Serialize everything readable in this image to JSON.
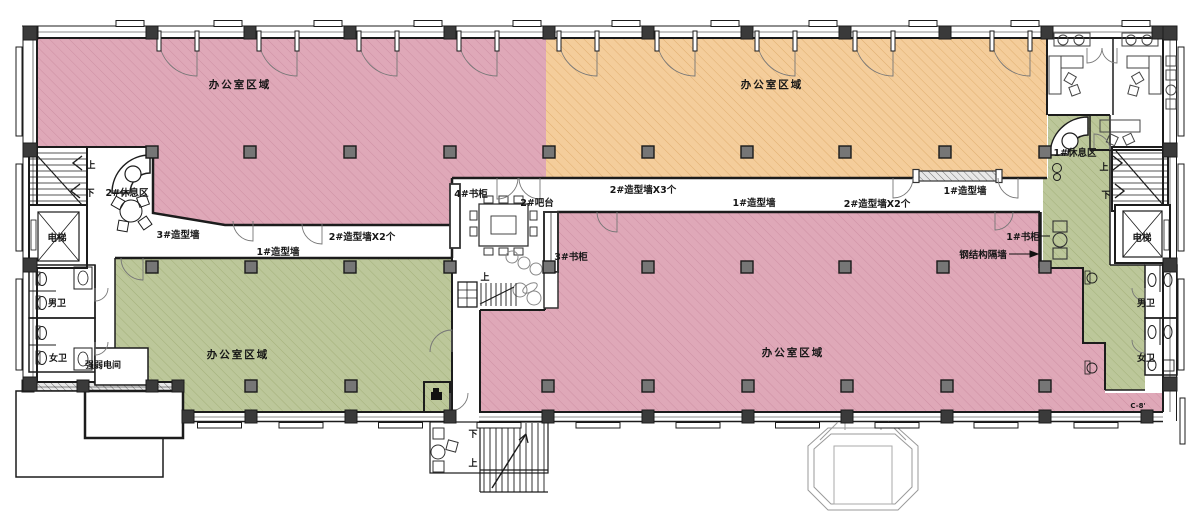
{
  "plan": {
    "type": "office-floor-plan",
    "labels": {
      "office_area_nw": "办公室区域",
      "office_area_ne": "办公室区域",
      "office_area_sw": "办公室区域",
      "office_area_se": "办公室区域",
      "rest_area_2": "2#休息区",
      "rest_area_1": "1#休息区",
      "elevator_left": "电梯",
      "elevator_right": "电梯",
      "feature_wall_3": "3#造型墙",
      "feature_wall_1_a": "1#造型墙",
      "feature_wall_2x2_a": "2#造型墙X2个",
      "feature_wall_2x3": "2#造型墙X3个",
      "feature_wall_1_b": "1#造型墙",
      "feature_wall_2x2_b": "2#造型墙X2个",
      "feature_wall_1_c": "1#造型墙",
      "bookcase_4": "4#书柜",
      "bookcase_3": "3#书柜",
      "bookcase_1": "1#书柜",
      "bar_2": "2#吧台",
      "steel_partition": "钢结构隔墙",
      "mens_wc_left": "男卫",
      "womens_wc_left": "女卫",
      "mens_wc_right": "男卫",
      "womens_wc_right": "女卫",
      "electrical_room": "强弱电间",
      "grid_ref": "C-8'",
      "up_stair_nw": "上",
      "down_stair_nw": "下",
      "up_hall": "上",
      "down_entrance": "下",
      "up_entrance": "上",
      "up_stair_ne": "上",
      "down_stair_ne": "下"
    },
    "colors": {
      "pink": "#DFA8B8",
      "pink_line": "#CE8FA3",
      "orange": "#F4CD9B",
      "orange_line": "#E0AE6F",
      "green": "#BCC79A",
      "green_line": "#A3B079",
      "wall": "#1c1c1c",
      "wall_column": "#3a3a3a",
      "interior_column": "#767676",
      "canopy_line": "#9a9a9a"
    },
    "structure": {
      "top_wall_columns_x": [
        32,
        152,
        250,
        350,
        450,
        549,
        648,
        747,
        845,
        945,
        1047,
        1158
      ],
      "bottom_wall_columns_x": [
        188,
        251,
        351,
        450,
        548,
        648,
        748,
        847,
        947,
        1045,
        1147
      ],
      "bottom_left_wall_columns_x": [
        28,
        83,
        152,
        178
      ],
      "left_wall_columns_y": [
        33,
        150,
        265,
        384
      ],
      "right_wall_columns_y": [
        33,
        150,
        265,
        384
      ],
      "interior_columns": [
        [
          152,
          152
        ],
        [
          250,
          152
        ],
        [
          350,
          152
        ],
        [
          450,
          152
        ],
        [
          549,
          152
        ],
        [
          648,
          152
        ],
        [
          747,
          152
        ],
        [
          845,
          152
        ],
        [
          945,
          152
        ],
        [
          1045,
          152
        ],
        [
          152,
          267
        ],
        [
          251,
          267
        ],
        [
          350,
          267
        ],
        [
          450,
          267
        ],
        [
          549,
          267
        ],
        [
          648,
          267
        ],
        [
          747,
          267
        ],
        [
          845,
          267
        ],
        [
          943,
          267
        ],
        [
          1045,
          267
        ],
        [
          251,
          386
        ],
        [
          351,
          386
        ],
        [
          548,
          386
        ],
        [
          648,
          386
        ],
        [
          748,
          386
        ],
        [
          847,
          386
        ],
        [
          947,
          386
        ],
        [
          1045,
          386
        ]
      ],
      "doors": [
        {
          "x": 197,
          "y": 38,
          "r": 38,
          "q": "sw",
          "jamb": true
        },
        {
          "x": 297,
          "y": 38,
          "r": 38,
          "q": "sw",
          "jamb": true
        },
        {
          "x": 397,
          "y": 38,
          "r": 38,
          "q": "sw",
          "jamb": true
        },
        {
          "x": 497,
          "y": 38,
          "r": 38,
          "q": "sw",
          "jamb": true
        },
        {
          "x": 597,
          "y": 38,
          "r": 38,
          "q": "sw",
          "jamb": true
        },
        {
          "x": 695,
          "y": 38,
          "r": 38,
          "q": "sw",
          "jamb": true
        },
        {
          "x": 795,
          "y": 38,
          "r": 38,
          "q": "sw",
          "jamb": true
        },
        {
          "x": 893,
          "y": 38,
          "r": 38,
          "q": "sw",
          "jamb": true
        },
        {
          "x": 1030,
          "y": 38,
          "r": 38,
          "q": "sw",
          "jamb": true
        },
        {
          "x": 253,
          "y": 221,
          "r": 20,
          "q": "sw"
        },
        {
          "x": 322,
          "y": 224,
          "r": 20,
          "q": "sw"
        },
        {
          "x": 143,
          "y": 258,
          "r": 22,
          "q": "sw"
        },
        {
          "x": 452,
          "y": 352,
          "r": 22,
          "q": "nw"
        },
        {
          "x": 497,
          "y": 178,
          "r": 21,
          "q": "se"
        },
        {
          "x": 540,
          "y": 178,
          "r": 21,
          "q": "sw"
        },
        {
          "x": 893,
          "y": 178,
          "r": 20,
          "q": "se"
        },
        {
          "x": 1018,
          "y": 178,
          "r": 20,
          "q": "sw"
        },
        {
          "x": 617,
          "y": 212,
          "r": 20,
          "q": "sw"
        },
        {
          "x": 995,
          "y": 212,
          "r": 18,
          "q": "se"
        },
        {
          "x": 450,
          "y": 393,
          "r": 18,
          "q": "se"
        },
        {
          "x": 95,
          "y": 288,
          "r": 13,
          "q": "se"
        },
        {
          "x": 95,
          "y": 342,
          "r": 13,
          "q": "se"
        },
        {
          "x": 1145,
          "y": 288,
          "r": 13,
          "q": "sw"
        },
        {
          "x": 1145,
          "y": 340,
          "r": 13,
          "q": "sw"
        },
        {
          "x": 1087,
          "y": 48,
          "r": 15,
          "q": "se"
        },
        {
          "x": 1117,
          "y": 48,
          "r": 15,
          "q": "sw"
        },
        {
          "x": 1094,
          "y": 150,
          "r": 16,
          "q": "ne"
        }
      ]
    }
  }
}
